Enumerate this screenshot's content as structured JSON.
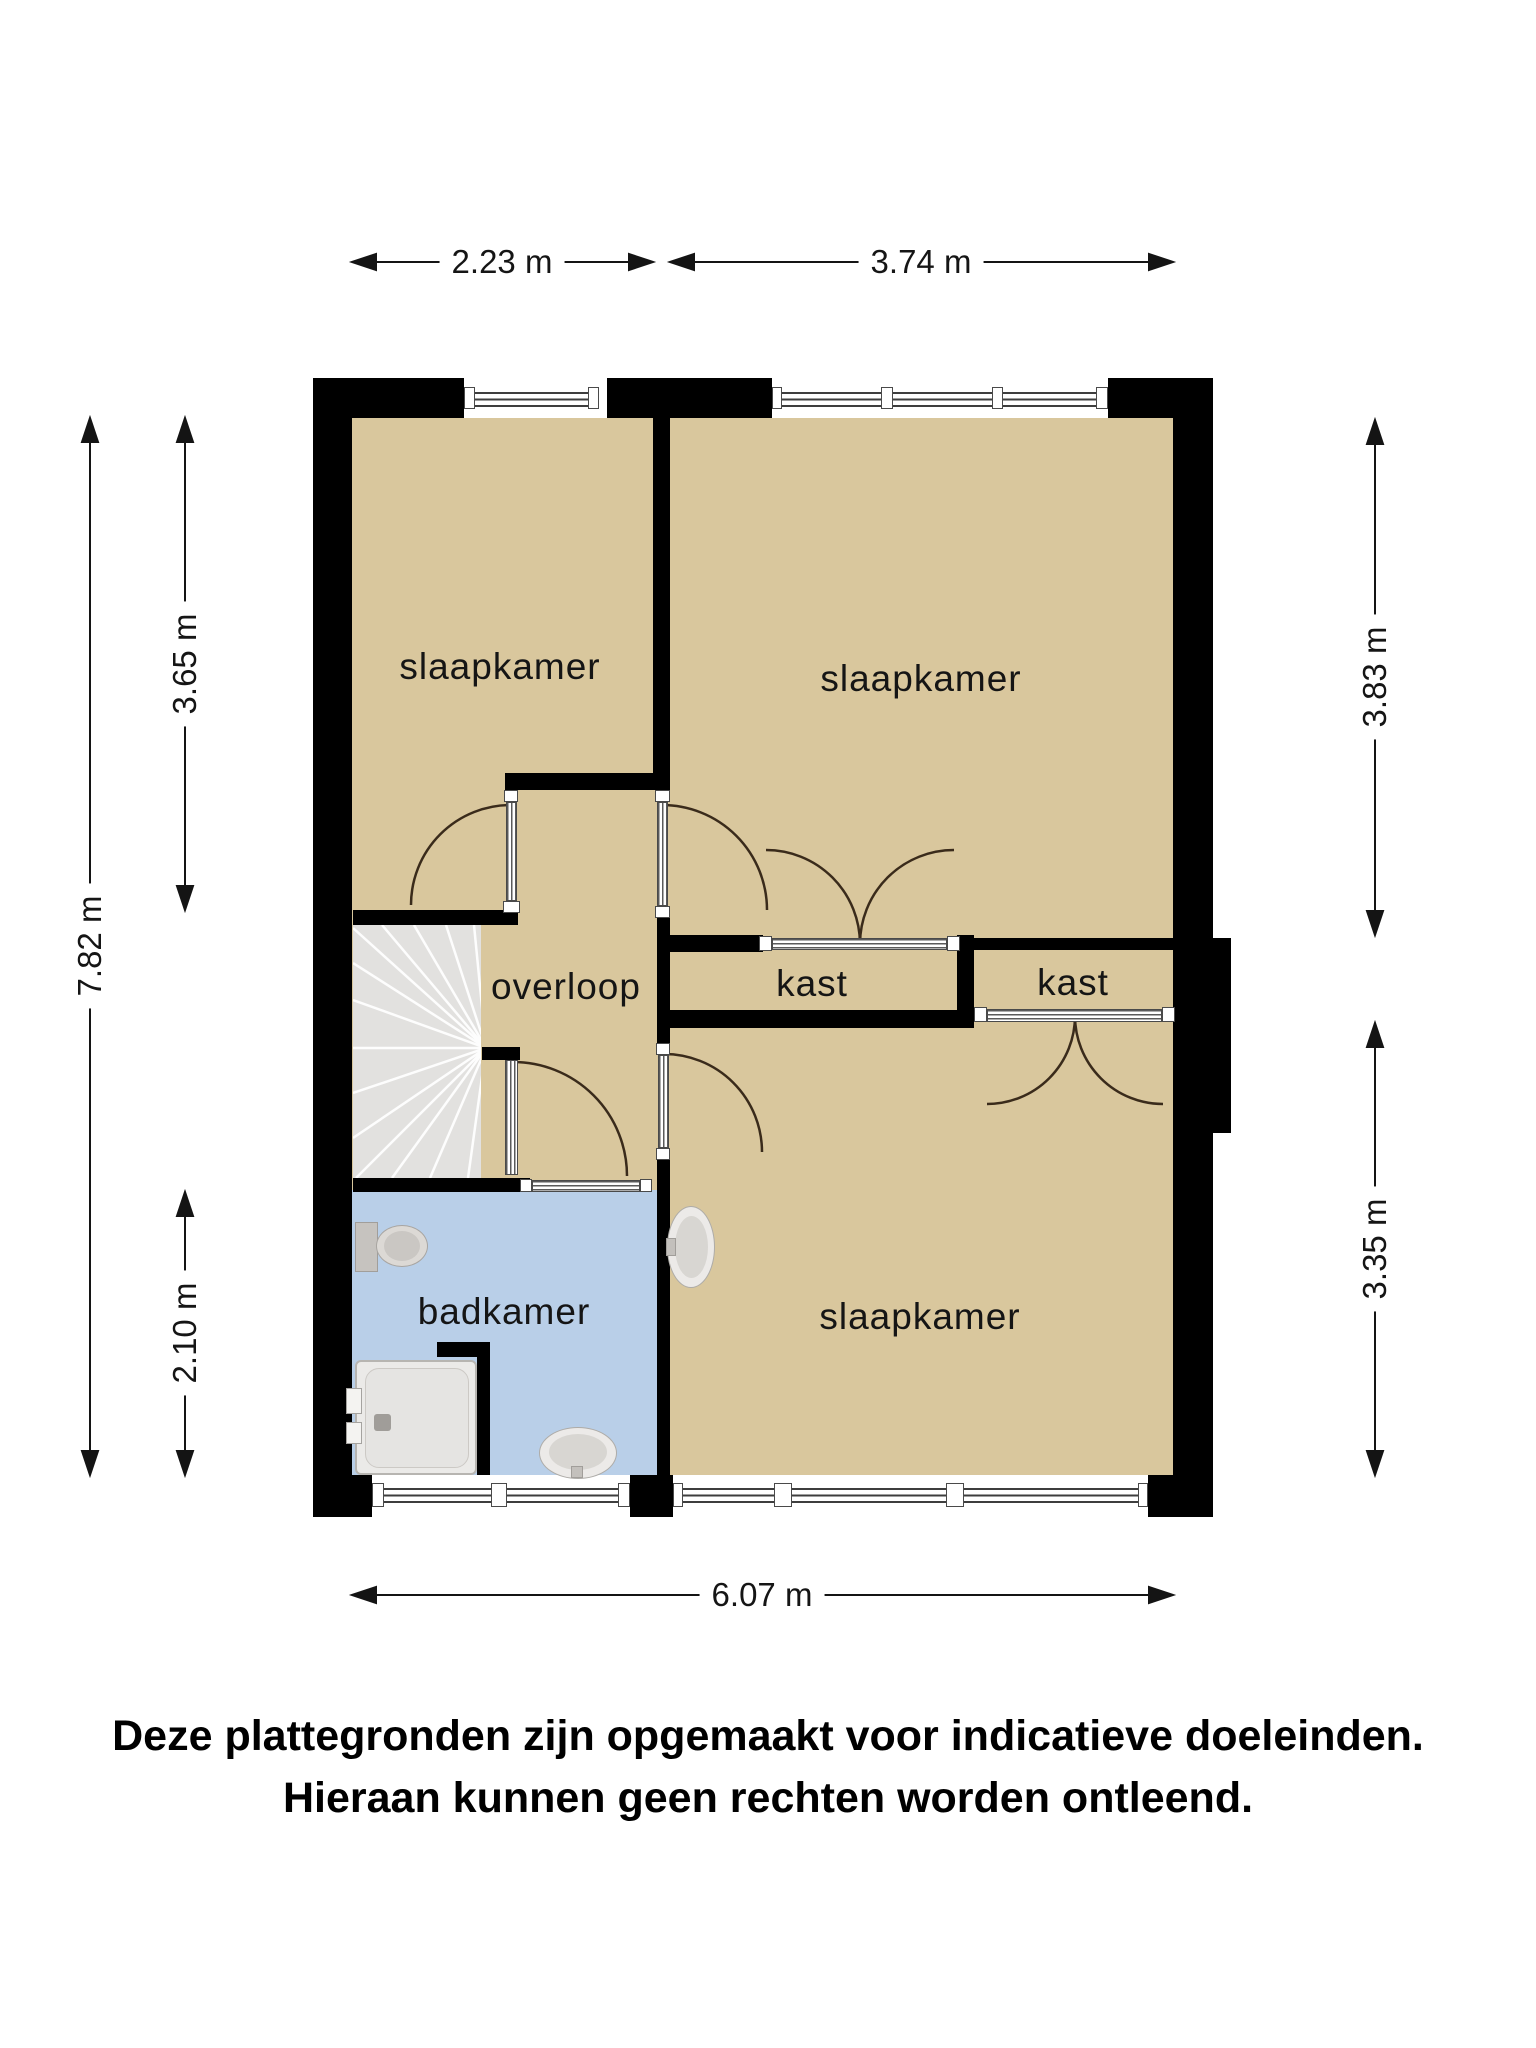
{
  "rooms": {
    "bedroom_tl": "slaapkamer",
    "bedroom_tr": "slaapkamer",
    "bedroom_br": "slaapkamer",
    "hallway": "overloop",
    "closet_left": "kast",
    "closet_right": "kast",
    "bathroom": "badkamer"
  },
  "dimensions": {
    "top_left_width": "2.23 m",
    "top_right_width": "3.74 m",
    "left_total_height": "7.82 m",
    "left_top_height": "3.65 m",
    "left_bottom_height": "2.10 m",
    "right_top_height": "3.83 m",
    "right_bottom_height": "3.35 m",
    "bottom_total_width": "6.07 m"
  },
  "disclaimer": {
    "line1": "Deze plattegronden zijn opgemaakt voor indicatieve doeleinden.",
    "line2": "Hieraan kunnen geen rechten worden ontleend."
  },
  "colors": {
    "room_floor": "#d9c79d",
    "bathroom_floor": "#b9cfe8",
    "stairs": "#e2e1df",
    "wall": "#000000",
    "door_arc": "#3a2b1b",
    "dimension": "#141414"
  },
  "icons": {
    "stairs": "stairs-icon",
    "toilet": "toilet-icon",
    "shower_tub": "bathtub-icon",
    "washbasin_bathroom": "washbasin-icon",
    "washbasin_bedroom": "washbasin-icon"
  }
}
